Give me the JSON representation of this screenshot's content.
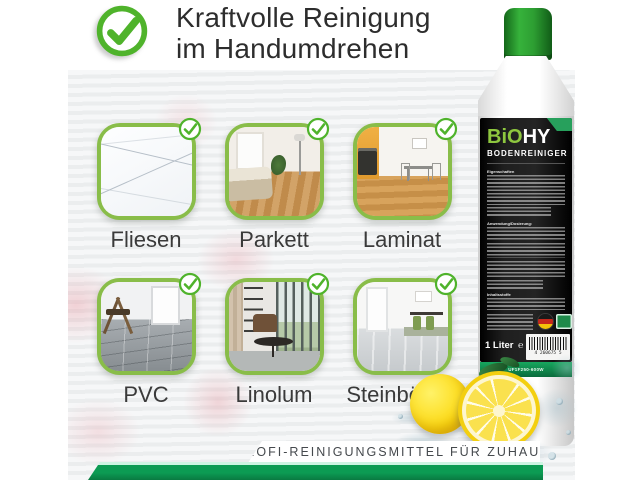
{
  "heading": {
    "line1": "Kraftvolle Reinigung",
    "line2": "im Handumdrehen"
  },
  "floor_types": [
    {
      "label": "Fliesen"
    },
    {
      "label": "Parkett"
    },
    {
      "label": "Laminat"
    },
    {
      "label": "PVC"
    },
    {
      "label": "Linolum"
    },
    {
      "label": "Steinböden"
    }
  ],
  "bottle": {
    "brand_prefix": "BiO",
    "brand_suffix": "HY",
    "product_name": "BODENREINIGER",
    "sections": {
      "s1": "Eigenschaften",
      "s2": "Anwendung/Dosierung:",
      "s3": "Inhaltsstoffe"
    },
    "volume": "1 Liter",
    "e_mark": "℮",
    "barcode_digits": "4 260675 5",
    "batch_code": "UF1F250-600W"
  },
  "banner": {
    "text": "PROFI-REINIGUNGSMITTEL FÜR ZUHAUSE"
  },
  "icons": {
    "heading_check": "check-circle",
    "tile_check": "check-circle",
    "flag": "german-flag",
    "eco": "eco-badge"
  },
  "colors": {
    "accent_green": "#89bd49",
    "check_green": "#4fb32b",
    "cap_green": "#2d9e32",
    "ribbon_green": "#27a05c",
    "bottom_bar_green": "#0c9b53",
    "label_bg": "#1f1f1f",
    "lemon_yellow": "#fcd912"
  }
}
